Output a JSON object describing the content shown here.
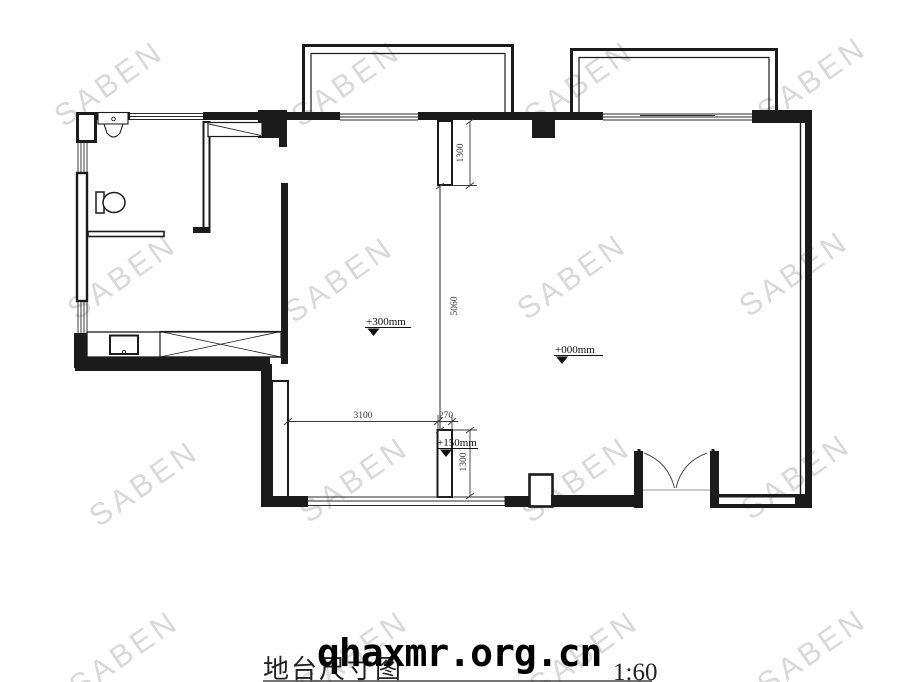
{
  "watermark": {
    "text": "SABEN",
    "color": "#d9d9d9"
  },
  "title_block": {
    "title": "地台尺寸图",
    "scale": "1:60",
    "website": "qhaxmr.org.cn"
  },
  "levels": {
    "platform": "+300mm",
    "main_floor": "+000mm",
    "step": "+150mm"
  },
  "dimensions": {
    "top_recess_depth": "1300",
    "platform_length": "5060",
    "platform_width": "3100",
    "strip_width": "270",
    "bottom_recess_depth": "1300"
  },
  "colors": {
    "line": "#1b1b1b",
    "dim": "#3a3a3a",
    "background": "#ffffff"
  }
}
